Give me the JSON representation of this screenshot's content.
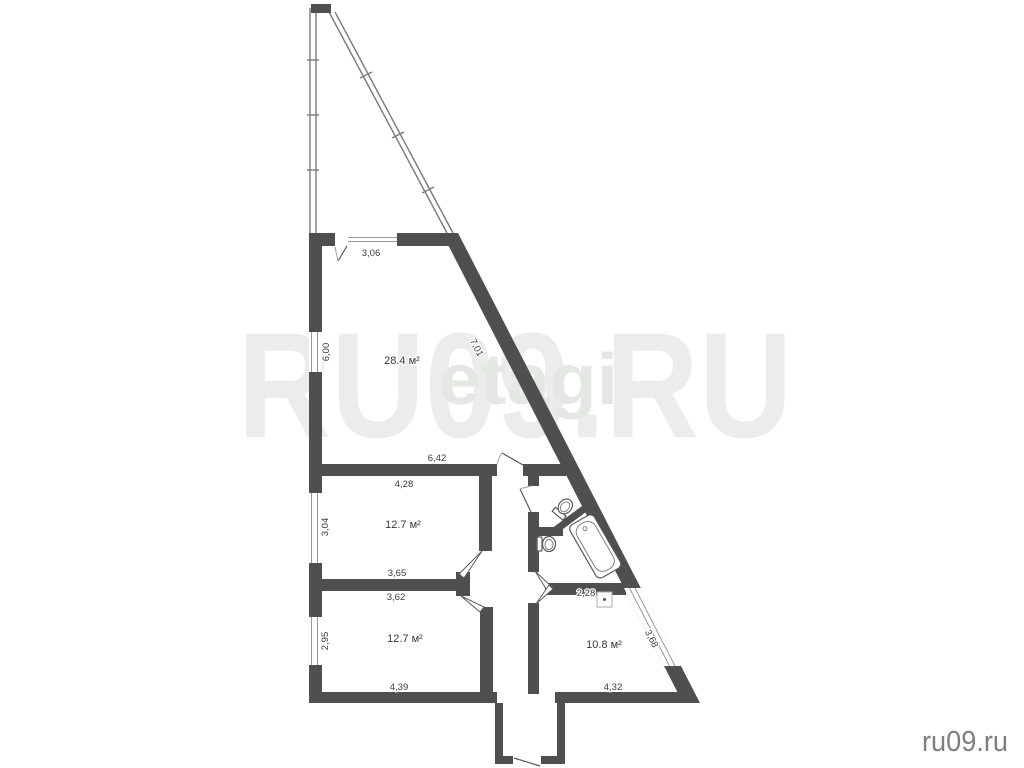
{
  "watermarks": {
    "large": "RU09.RU",
    "agency": "etagi",
    "site": "ru09.ru"
  },
  "rooms": {
    "living": {
      "area": "28.4 м²"
    },
    "bedroom_top": {
      "area": "12.7 м²"
    },
    "bedroom_bottom": {
      "area": "12.7 м²"
    },
    "room_right": {
      "area": "10.8 м²"
    }
  },
  "dimensions": {
    "balcony_window": "3,06",
    "living_left": "6,00",
    "living_diagonal": "7,01",
    "hall_top": "6,42",
    "bedroom_top_width": "4,28",
    "bedroom_top_left": "3,04",
    "bedroom_top_bottom": "3,65",
    "bedroom_bottom_top": "3,62",
    "bedroom_bottom_left": "2,95",
    "bath_width": "2,28",
    "room_right_diagonal": "3,68",
    "bedroom_bottom_width": "4,39",
    "room_right_width": "4,32"
  }
}
